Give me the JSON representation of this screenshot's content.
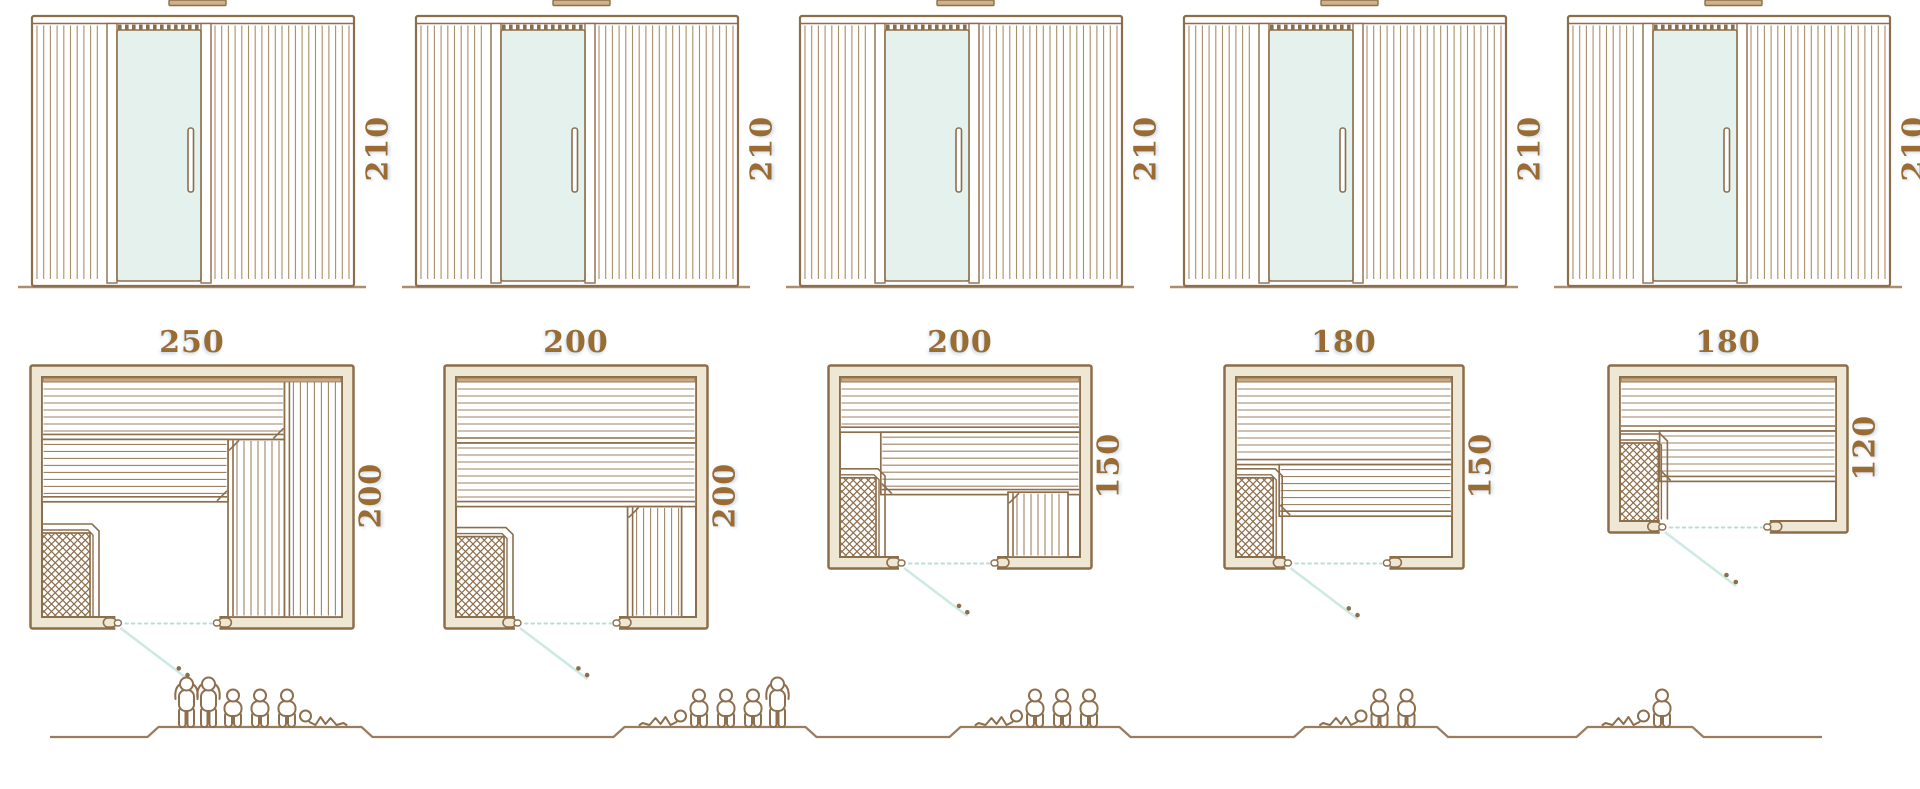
{
  "units": "cm",
  "colors": {
    "line": "#8d6e4b",
    "slat": "#a08258",
    "floor": "#a98f6e",
    "tan": "#cfb28c",
    "wall_fill": "#ede7d4",
    "glass": "#e4f1ed",
    "swing": "#cde9e4",
    "dotted": "#b9ded6",
    "text": "#9a6c31",
    "people": "#8d6f4e"
  },
  "cabins": [
    {
      "id": "cabin-1",
      "elevation_height_label": "210",
      "elevation_height_cm": 210,
      "plan_width_label": "250",
      "plan_depth_label": "200",
      "plan_width_cm": 250,
      "plan_depth_cm": 200,
      "capacity": {
        "standing": 2,
        "seated": 3,
        "lying": 1,
        "total": 6
      },
      "plan_geometry": {
        "w": 250,
        "d": 200,
        "benches": [
          {
            "x": 202,
            "y": 0,
            "w": 48,
            "h": 200,
            "dir": "v",
            "edge": "l"
          },
          {
            "x": 155,
            "y": 52,
            "w": 47,
            "h": 148,
            "dir": "v",
            "edge": "l",
            "bevel": "tl"
          },
          {
            "x": 0,
            "y": 0,
            "w": 202,
            "h": 52,
            "dir": "h",
            "edge": "b",
            "bevel": "br"
          },
          {
            "x": 0,
            "y": 52,
            "w": 155,
            "h": 52,
            "dir": "h",
            "edge": "b",
            "bevel": "br"
          }
        ],
        "heater": {
          "x": 0,
          "y": 130,
          "w": 40,
          "h": 70
        },
        "door": {
          "x": 62,
          "w": 85
        }
      }
    },
    {
      "id": "cabin-2",
      "elevation_height_label": "210",
      "elevation_height_cm": 210,
      "plan_width_label": "200",
      "plan_depth_label": "200",
      "plan_width_cm": 200,
      "plan_depth_cm": 200,
      "capacity": {
        "standing": 1,
        "seated": 3,
        "lying": 1,
        "total": 5
      },
      "plan_geometry": {
        "w": 200,
        "d": 200,
        "benches": [
          {
            "x": 0,
            "y": 0,
            "w": 200,
            "h": 55,
            "dir": "h",
            "edge": "b"
          },
          {
            "x": 0,
            "y": 55,
            "w": 200,
            "h": 53,
            "dir": "h",
            "edge": "b"
          },
          {
            "x": 143,
            "y": 108,
            "w": 45,
            "h": 92,
            "dir": "v",
            "edge": "l",
            "bevel": "tl"
          }
        ],
        "heater": {
          "x": 0,
          "y": 133,
          "w": 40,
          "h": 67
        },
        "door": {
          "x": 50,
          "w": 85
        }
      }
    },
    {
      "id": "cabin-3",
      "elevation_height_label": "210",
      "elevation_height_cm": 210,
      "plan_width_label": "200",
      "plan_depth_label": "150",
      "plan_width_cm": 200,
      "plan_depth_cm": 150,
      "capacity": {
        "standing": 0,
        "seated": 3,
        "lying": 1,
        "total": 4
      },
      "plan_geometry": {
        "w": 200,
        "d": 150,
        "benches": [
          {
            "x": 0,
            "y": 0,
            "w": 200,
            "h": 46,
            "dir": "h",
            "edge": "b"
          },
          {
            "x": 34,
            "y": 46,
            "w": 166,
            "h": 52,
            "dir": "h",
            "edge": "b",
            "bevel": "bl"
          },
          {
            "x": 140,
            "y": 96,
            "w": 50,
            "h": 54,
            "dir": "v",
            "edge": "l",
            "bevel": "tl"
          }
        ],
        "heater": {
          "x": 0,
          "y": 84,
          "w": 30,
          "h": 66
        },
        "door": {
          "x": 50,
          "w": 80
        }
      }
    },
    {
      "id": "cabin-4",
      "elevation_height_label": "210",
      "elevation_height_cm": 210,
      "plan_width_label": "180",
      "plan_depth_label": "150",
      "plan_width_cm": 180,
      "plan_depth_cm": 150,
      "capacity": {
        "standing": 0,
        "seated": 2,
        "lying": 1,
        "total": 3
      },
      "plan_geometry": {
        "w": 180,
        "d": 150,
        "benches": [
          {
            "x": 0,
            "y": 0,
            "w": 180,
            "h": 73,
            "dir": "h",
            "edge": "b"
          },
          {
            "x": 36,
            "y": 73,
            "w": 144,
            "h": 43,
            "dir": "h",
            "edge": "b",
            "bevel": "bl"
          }
        ],
        "heater": {
          "x": 0,
          "y": 84,
          "w": 31,
          "h": 66
        },
        "door": {
          "x": 42,
          "w": 85
        }
      }
    },
    {
      "id": "cabin-5",
      "elevation_height_label": "210",
      "elevation_height_cm": 210,
      "plan_width_label": "180",
      "plan_depth_label": "120",
      "plan_width_cm": 180,
      "plan_depth_cm": 120,
      "capacity": {
        "standing": 0,
        "seated": 1,
        "lying": 1,
        "total": 2
      },
      "plan_geometry": {
        "w": 180,
        "d": 120,
        "benches": [
          {
            "x": 0,
            "y": 0,
            "w": 180,
            "h": 45,
            "dir": "h",
            "edge": "b"
          },
          {
            "x": 33,
            "y": 45,
            "w": 147,
            "h": 42,
            "dir": "h",
            "edge": "b",
            "bevel": "bl"
          }
        ],
        "heater": {
          "x": 0,
          "y": 55,
          "w": 32,
          "h": 65
        },
        "door": {
          "x": 34,
          "w": 90
        }
      }
    }
  ]
}
